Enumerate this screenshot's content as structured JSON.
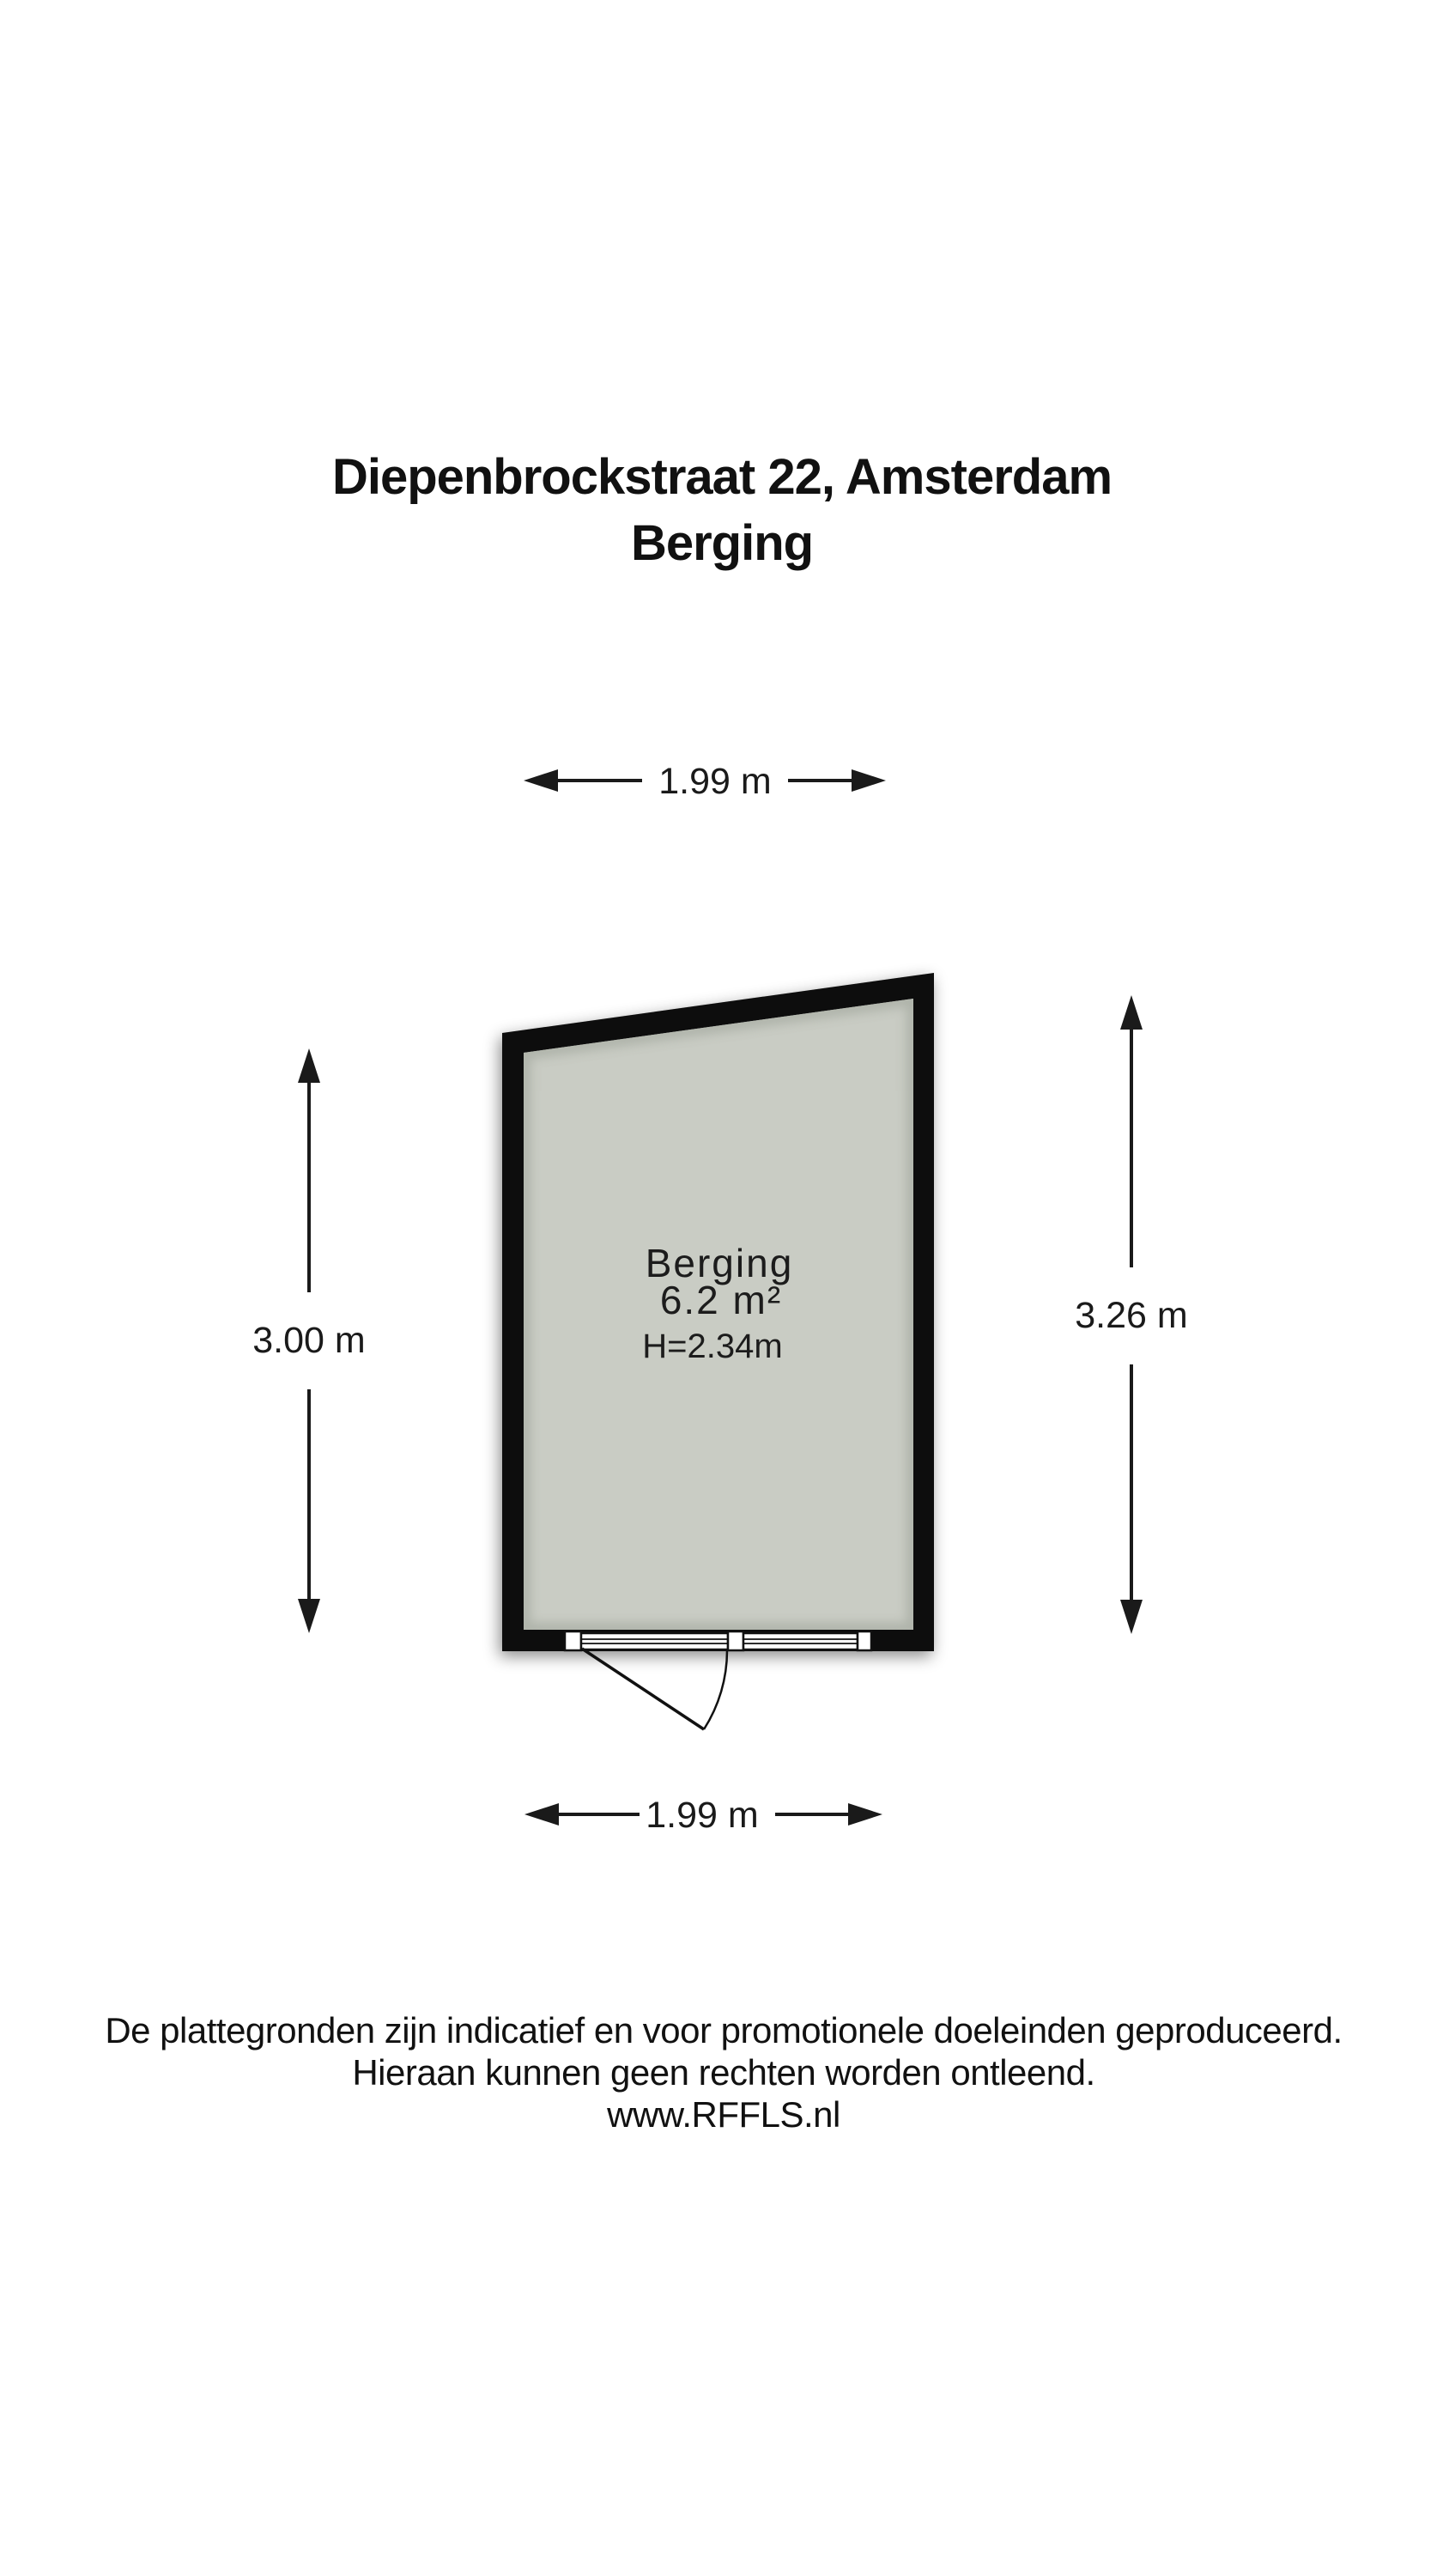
{
  "title": {
    "line1": "Diepenbrockstraat 22, Amsterdam",
    "line2": "Berging"
  },
  "dimensions": {
    "top": "1.99 m",
    "bottom": "1.99 m",
    "left": "3.00 m",
    "right": "3.26 m"
  },
  "room": {
    "name": "Berging",
    "area": "6.2 m²",
    "ceiling_height": "H=2.34m"
  },
  "footer": {
    "line1": "De plattegronden zijn indicatief en voor promotionele doeleinden geproduceerd.",
    "line2": "Hieraan kunnen geen rechten worden ontleend.",
    "line3": "www.RFFLS.nl"
  },
  "colors": {
    "wall": "#0a0a0a",
    "floor": "#c9ccc4",
    "floor_shadow": "#8f958a"
  }
}
